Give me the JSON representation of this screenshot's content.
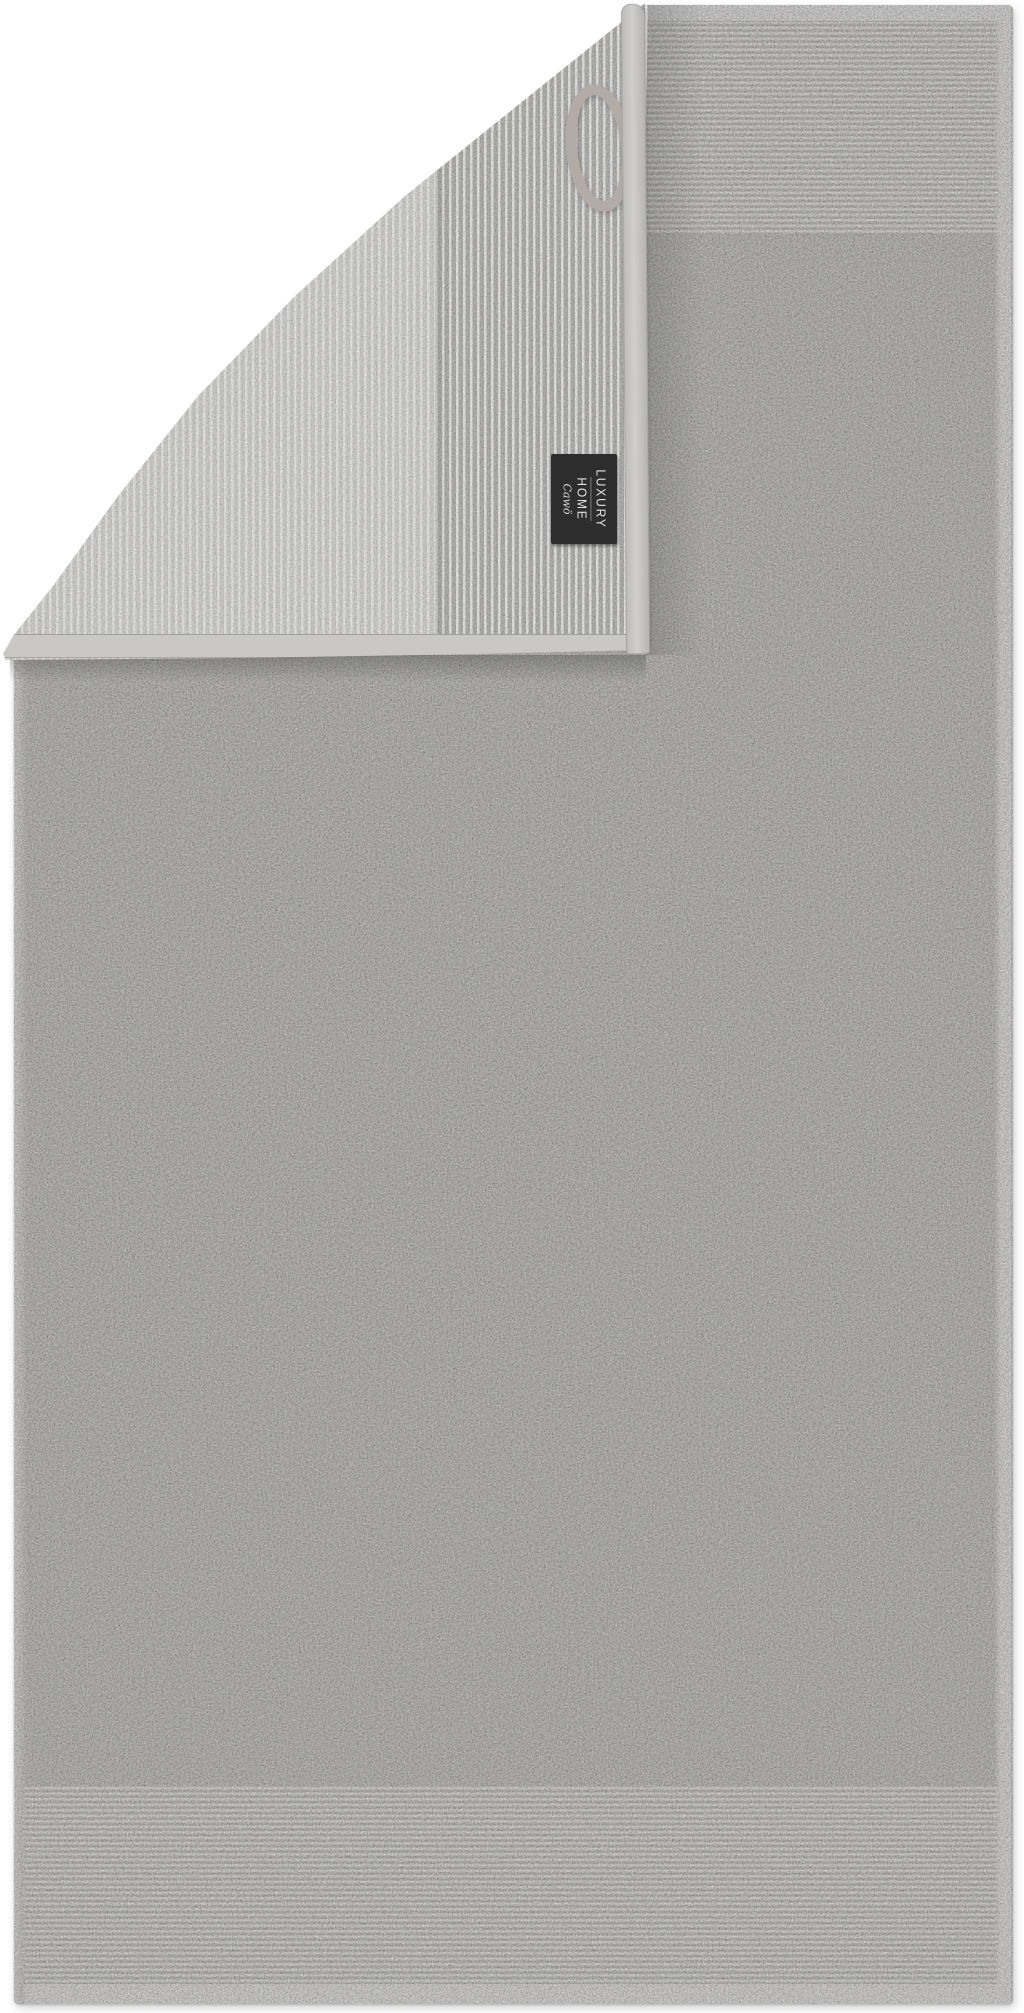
{
  "photo": {
    "type": "product-photo",
    "subject": "two-tone grey terry towel with folded corner, hanger loop and brand tag",
    "label_tag": {
      "line1": "LUXURY",
      "line2": "HOME",
      "brand": "Cawö"
    },
    "colors": {
      "background": "#ffffff",
      "towel_front": "#a5a4a2",
      "stripe_light": "#cfcecc",
      "stripe_dark": "#9e9d9b",
      "back_light": "#d3d2d0",
      "back_ribbed": "#b3b2b0",
      "binding": "#c9c8c6",
      "hem": "#c9c8c6",
      "loop": "#b2aba7",
      "tag_bg": "#2d2d2d",
      "tag_text": "#e3e3e3"
    }
  }
}
